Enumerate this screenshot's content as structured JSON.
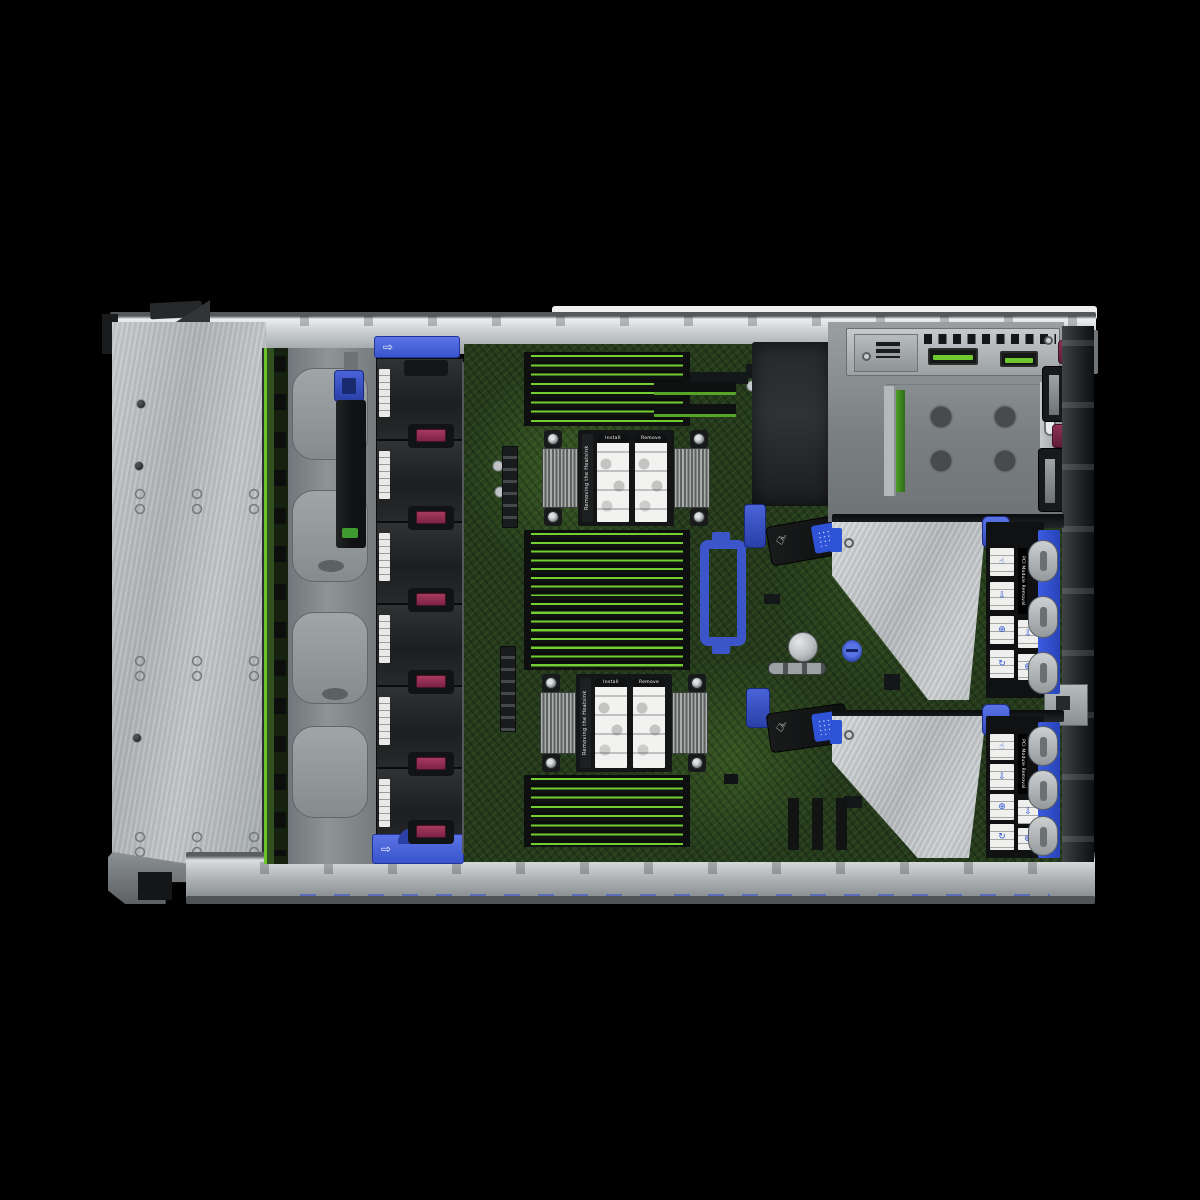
{
  "scene": {
    "title": "Rack server internal top view",
    "description": "Top-down product photo of a 2U rack server with the access panel removed: drive-bay plate and backplane on the left, six hot-plug fan modules, dual CPU heatsinks flanked by DIMM banks on a green motherboard, two PCIe riser cages on the right, and an OCP/power-supply bay in the top-right corner."
  },
  "colors": {
    "background": "#000000",
    "chassis_silver": "#b9bdbf",
    "plate_aluminum": "#b3b7b9",
    "board_green": "#2a3d1e",
    "dimm_edge_green": "#73cf31",
    "fan_black": "#1e2022",
    "fan_latch_maroon": "#8f2f52",
    "touchpoint_blue": "#3c55c9",
    "psu_handle_maroon": "#7e2742",
    "warning_yellow": "#e3c419",
    "label_white": "#efefed"
  },
  "icons": {
    "arrow_right": "⇨",
    "fan": "✻",
    "hand_point": "☝",
    "riser_glyphs": [
      "☝",
      "⇩",
      "⊕",
      "↻"
    ]
  },
  "fan_bank": {
    "fans": [
      {
        "number": "1"
      },
      {
        "number": "2"
      },
      {
        "number": "3"
      },
      {
        "number": "4"
      },
      {
        "number": "5"
      },
      {
        "number": "6"
      }
    ]
  },
  "motherboard": {
    "heatsink_label": "Removing the Heatsink",
    "sticker_headers": [
      "Install",
      "Remove"
    ],
    "dimm_banks": [
      {
        "slots": 8
      },
      {
        "slots": 16
      },
      {
        "slots": 8
      }
    ],
    "cpu_count": 2
  },
  "riser_cages": [
    {
      "strip_label": "PCI Module Removal",
      "latches": 3,
      "stickers": 4
    },
    {
      "strip_label": "PCI Module Removal",
      "latches": 3,
      "stickers": 4
    }
  ],
  "power": {
    "psu_count": 2
  }
}
